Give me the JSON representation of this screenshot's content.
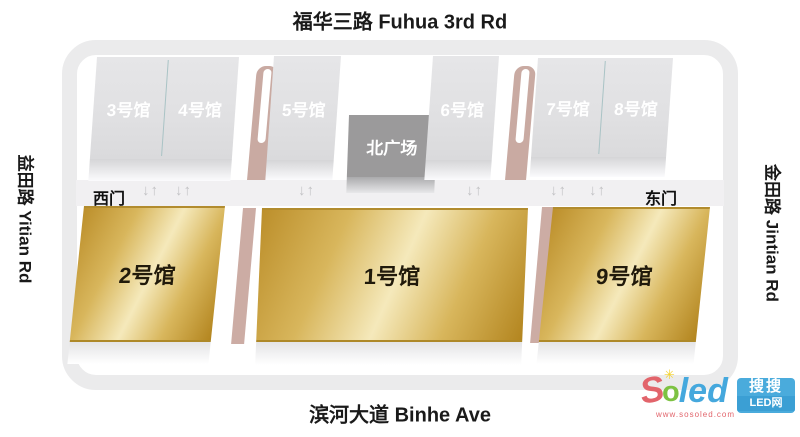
{
  "roads": {
    "top": "福华三路 Fuhua 3rd Rd",
    "bottom": "滨河大道 Binhe Ave",
    "left": "益田路 Yitian Rd",
    "right": "金田路 Jintian Rd"
  },
  "gates": {
    "west": "西门",
    "east": "东门"
  },
  "plaza": {
    "label": "北广场"
  },
  "gray_halls": [
    {
      "id": "hall-3",
      "label": "3号馆"
    },
    {
      "id": "hall-4",
      "label": "4号馆"
    },
    {
      "id": "hall-5",
      "label": "5号馆"
    },
    {
      "id": "hall-6",
      "label": "6号馆"
    },
    {
      "id": "hall-7",
      "label": "7号馆"
    },
    {
      "id": "hall-8",
      "label": "8号馆"
    }
  ],
  "gold_halls": [
    {
      "id": "hall-2",
      "label": "2号馆"
    },
    {
      "id": "hall-1",
      "label": "1号馆"
    },
    {
      "id": "hall-9",
      "label": "9号馆"
    }
  ],
  "icons": {
    "arrow_pair": "↓↑",
    "sun_rays": "✳"
  },
  "logo": {
    "s": "S",
    "o": "o",
    "led": "led",
    "url": "www.sosoled.com",
    "box_line1": "搜搜",
    "box_line2": "LED网"
  },
  "colors": {
    "gold_dark": "#b3851f",
    "gold_light": "#f5e9bb",
    "gray_hall": "#e0e0e2",
    "plaza_gray": "#9b9a9b",
    "path_pink": "#c9aaa2",
    "ring_road": "#ebebec",
    "middle_road": "#f1f0f2",
    "logo_red": "#e2646b",
    "logo_green": "#7dc242",
    "logo_blue": "#45a8dd",
    "logo_yellow": "#f4d22b"
  }
}
